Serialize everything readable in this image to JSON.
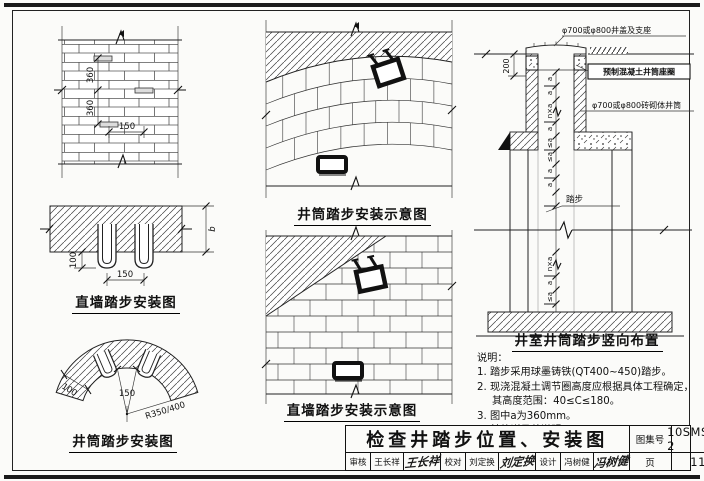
{
  "diagrams": {
    "wall_elevation": {
      "dim_upper": "360",
      "dim_lower": "360",
      "dim_width": "150"
    },
    "straight_wall_install": {
      "caption": "直墙踏步安装图",
      "dim_embed": "100",
      "dim_spacing": "150",
      "dim_wall_thickness": "b"
    },
    "shaft_install": {
      "caption": "井筒踏步安装图",
      "dim_spacing": "150",
      "dim_embed": "100",
      "dim_radius": "R350/400"
    },
    "shaft_schematic": {
      "caption": "井筒踏步安装示意图"
    },
    "straight_wall_schematic": {
      "caption": "直墙踏步安装示意图"
    },
    "vertical_layout": {
      "caption": "井室井筒踏步竖向布置",
      "label_cover": "φ700或φ800井盖及支座",
      "label_seat_ring": "预制混凝土井筒座圈",
      "label_shaft": "φ700或φ800砖砌体井筒",
      "label_step": "踏步",
      "dim_top": "200",
      "dim_chain": [
        "a",
        "a",
        "n×a",
        "a",
        "≤a",
        "≤a",
        "a",
        "a",
        "n×a",
        "a",
        "≤a"
      ]
    }
  },
  "notes": {
    "heading": "说明：",
    "line1": "1. 踏步采用球墨铸铁(QT400~450)踏步。",
    "line2": "2. 现浇混凝土调节圈高度应根据具体工程确定，",
    "line3": "其高度范围：40≤C≤180。",
    "line4": "3. 图中a为360mm。",
    "line5": "4. 其他详见总说明。"
  },
  "titleblock": {
    "title": "检查井踏步位置、安装图",
    "atlas_label": "图集号",
    "atlas_no": "10SMS202-2",
    "page_label": "页",
    "page_no": "114",
    "review_label": "审核",
    "review_name": "王长祥",
    "check_label": "校对",
    "check_name": "刘定换",
    "design_label": "设计",
    "design_name": "冯树健"
  }
}
